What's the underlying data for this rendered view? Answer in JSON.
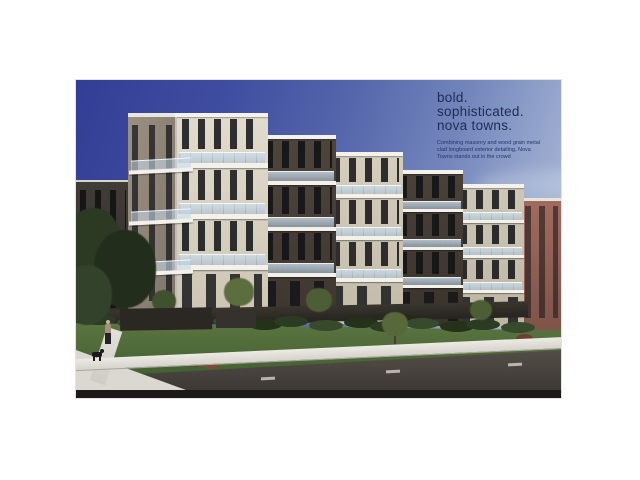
{
  "document": {
    "background": "#ffffff"
  },
  "hero": {
    "headline_lines": [
      "bold.",
      "sophisticated.",
      "nova towns."
    ],
    "tagline": "Combining masonry and wood grain metal clad longboard exterior detailing, Nova Towns stands out in the crowd",
    "headline_color": "#1d2a57",
    "tagline_color": "#24356b"
  },
  "scene": {
    "subject": "Nova Towns four-storey modern townhomes with glass balconies",
    "setting": "corner street view with lawn, sidewalks, road and a pedestrian walking a dog under a deep blue sky",
    "palette": {
      "sky_top": "#323e95",
      "sky_horizon": "#bcc8e0",
      "masonry_light": "#d8d1c2",
      "masonry_dark": "#463d36",
      "balcony_glass": "#c2d6e6",
      "lawn": "#4c6636",
      "road": "#4c4641",
      "neighbor_brick": "#9a655b",
      "headline_text": "#1d2a57"
    }
  }
}
